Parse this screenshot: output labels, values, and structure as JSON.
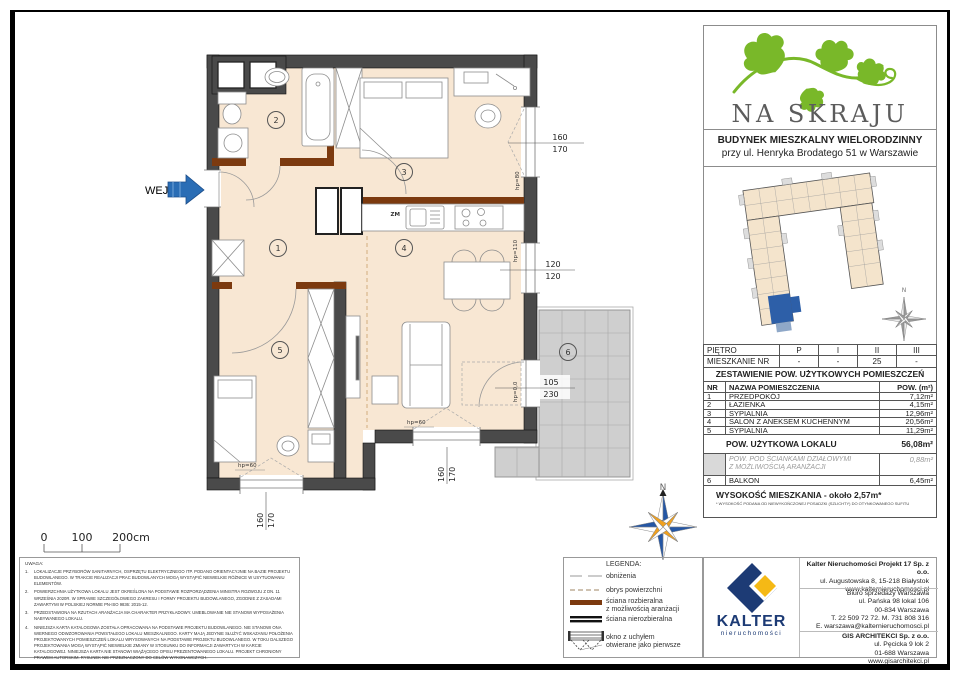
{
  "brand": {
    "title": "NA SKRAJU",
    "building_line1": "BUDYNEK MIESZKALNY WIELORODZINNY",
    "building_line2": "przy ul. Henryka Brodatego 51 w Warszawie"
  },
  "colors": {
    "brand_green": "#79b829",
    "navy": "#1d3b75",
    "yellow": "#f5b915",
    "highlight_blue": "#2d5fa8",
    "wall": "#4a4a4a",
    "floor": "#f8e7d3",
    "removable_wall_brown": "#7c3a0f"
  },
  "plan": {
    "entrance": "WEJŚCIE",
    "zm": "ZM",
    "north": "N",
    "rooms": [
      "1",
      "2",
      "3",
      "4",
      "5",
      "6"
    ],
    "dims": {
      "d1": [
        "160",
        "170"
      ],
      "d2": [
        "120",
        "120"
      ],
      "d3": [
        "105",
        "230"
      ],
      "d4": [
        "160",
        "170"
      ],
      "d5": [
        "160",
        "170"
      ]
    },
    "hp": {
      "h1": "hp=80",
      "h2": "hp=110",
      "h3": "hp=0,0",
      "h4": "hp=60",
      "h5": "hp=60"
    },
    "scale": [
      "0",
      "100",
      "200cm"
    ]
  },
  "panel": {
    "floor_table": {
      "r1": {
        "label": "PIĘTRO",
        "c": [
          "P",
          "I",
          "II",
          "III"
        ]
      },
      "r2": {
        "label": "MIESZKANIE NR",
        "c": [
          "-",
          "-",
          "25",
          "-"
        ]
      }
    },
    "area_table": {
      "title": "ZESTAWIENIE POW. UŻYTKOWYCH POMIESZCZEŃ",
      "headers": [
        "NR",
        "NAZWA POMIESZCZENIA",
        "POW. (m²)"
      ],
      "rows": [
        [
          "1",
          "PRZEDPOKÓJ",
          "7,12m²"
        ],
        [
          "2",
          "ŁAZIENKA",
          "4,15m²"
        ],
        [
          "3",
          "SYPIALNIA",
          "12,96m²"
        ],
        [
          "4",
          "SALON Z ANEKSEM KUCHENNYM",
          "20,56m²"
        ],
        [
          "5",
          "SYPIALNIA",
          "11,29m²"
        ]
      ],
      "total_label": "POW. UŻYTKOWA LOKALU",
      "total_value": "56,08m²",
      "partition_line1": "POW. POD ŚCIANKAMI DZIAŁOWYMI",
      "partition_line2": "Z MOŻLIWOŚCIĄ ARANŻACJI",
      "partition_value": "0,88m²",
      "balcony_nr": "6",
      "balcony_label": "BALKON",
      "balcony_value": "6,45m²",
      "height_label": "WYSOKOŚĆ MIESZKANIA - około 2,57m*",
      "height_note": "* WYSOKOŚĆ PODANA OD NIEWYKOŃCZONEJ POSADZKI (SZLICHTY) DO OTYNKOWANEGO SUFITU"
    }
  },
  "legend": {
    "title": "LEGENDA:",
    "i1": "obniżenia",
    "i2": "obrys powierzchni",
    "i3a": "ściana rozbieralna",
    "i3b": "z możliwością aranżacji",
    "i4": "ściana nierozbieralna",
    "i5a": "okno z uchyłem",
    "i5b": "otwierane jako pierwsze"
  },
  "notes": {
    "title": "UWAGA:",
    "items": [
      {
        "n": "1.",
        "t": "LOKALIZACJE PRZYBORÓW SANITARNYCH, OSPRZĘTU ELEKTRYCZNEGO ITP. PODANO ORIENTACYJNIE NA BAZIE PROJEKTU BUDOWLANEGO. W TRAKCIE REALIZACJI PRAC BUDOWLANYCH MOGĄ WYSTĄPIĆ NIEWIELKIE RÓŻNICE W USYTUOWANIU ELEMENTÓW."
      },
      {
        "n": "2.",
        "t": "POWIERZCHNIA UŻYTKOWA LOKALU JEST OKREŚLONA NA PODSTAWIE ROZPORZĄDZENIA MINISTRA ROZWOJU Z DN. 11 WRZEŚNIA 2020R. W SPRAWIE SZCZEGÓŁOWEGO ZAKRESU I FORMY PROJEKTU BUDOWLANEGO, ZGODNIE Z ZASADAMI ZAWARTYMI W POLSKIEJ NORMIE PN-ISO 9836: 2015-12."
      },
      {
        "n": "3.",
        "t": "PRZEDSTAWIONA NA RZUTACH ARANŻACJA MA CHARAKTER PRZYKŁADOWY. UMEBLOWANIE NIE STANOWI WYPOSAŻENIA NABYWANEGO LOKALU."
      },
      {
        "n": "4.",
        "t": "NINIEJSZA KARTA KATALOGOWA ZOSTAŁA OPRACOWANA NA PODSTAWIE PROJEKTU BUDOWLANEGO. NIE STANOWI ONA WIERNEGO ODWZOROWANIA POWSTAŁEGO LOKALU MIESZKALNEGO. KARTY MAJĄ JEDYNIE SŁUŻYĆ WSKAZANIU POŁOŻENIA PROJEKTOWANYCH POMIESZCZEŃ LOKALU WRYSOWANYCH NA PODSTAWIE PROJEKTU BUDOWLANEGO. W TOKU DALSZEGO PROJEKTOWANIA MOGĄ WYSTĄPIĆ NIEWIELKIE ZMIANY W STOSUNKU DO INFORMACJI ZAWARTYCH W KARCIE KATALOGOWEJ. NINIEJSZA KARTA NIE STANOWI WIĄŻĄCEGO OPISU PREZENTOWANEGO LOKALU. PROJEKT CHRONIONY PRAWEM AUTORSKIM. RYSUNEK NIE PRZEZNACZONY DO CELÓW WYKONAWCZYCH."
      }
    ]
  },
  "company": {
    "logo_text": "KALTER",
    "logo_sub": "nieruchomości",
    "name1": "Kalter Nieruchomości Projekt 17 Sp. z o.o.",
    "addr1a": "ul. Augustowska 8, 15-218 Białystok",
    "addr1b": "www.kalternieruchomosci.pl",
    "office1": "Biuro sprzedaży Warszawa",
    "office2": "ul. Pańska 98 lokal 106",
    "office3": "00-834 Warszawa",
    "office4": "T. 22 509 72 72. M. 731 808 316",
    "office5": "E. warszawa@kalternieruchomosci.pl",
    "name3": "GIS ARCHITEKCI Sp. z o.o.",
    "addr3a": "ul. Pęcicka 9 lok 2",
    "addr3b": "01-688 Warszawa",
    "addr3c": "www.gisarchitekci.pl"
  }
}
